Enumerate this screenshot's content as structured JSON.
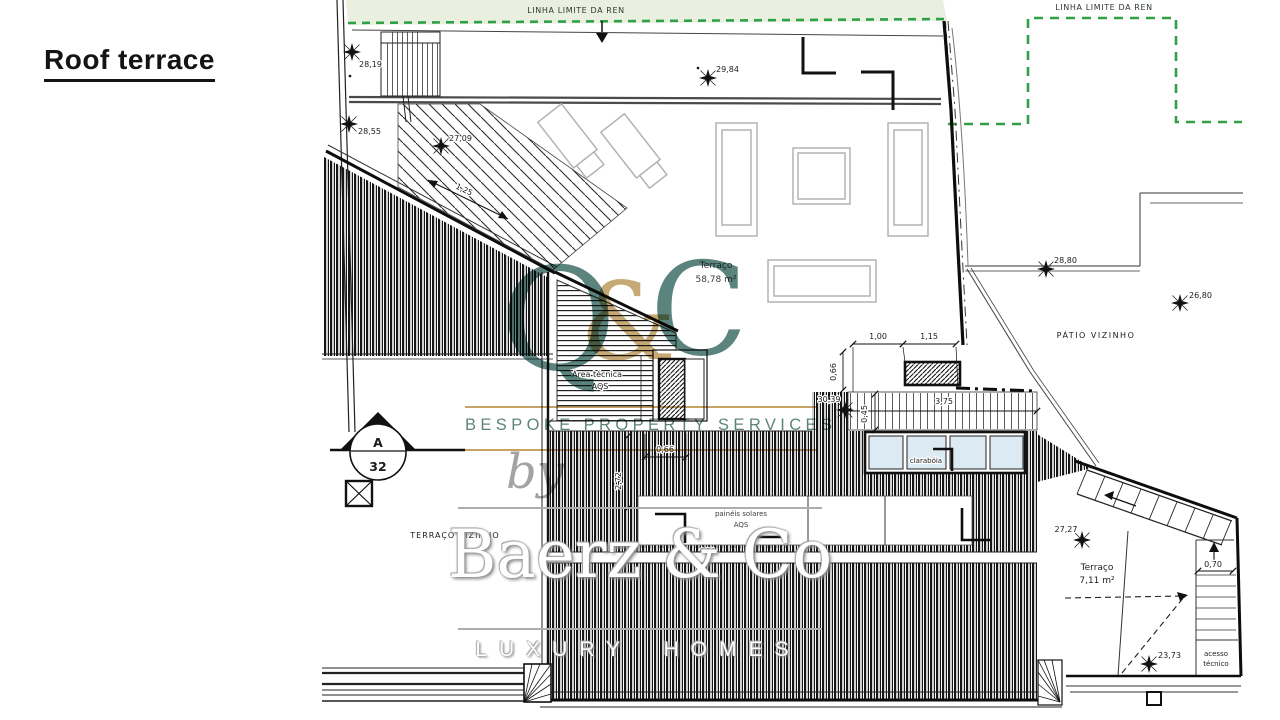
{
  "page": {
    "title": "Roof terrace"
  },
  "plan": {
    "ren_label": "LINHA LIMITE DA REN",
    "areas": {
      "main": {
        "name": "Terraço",
        "size": "58,78 m²"
      },
      "small": {
        "name": "Terraço",
        "size": "7,11 m²"
      },
      "tecnica": {
        "line1": "Área técnica",
        "line2": "AQS"
      },
      "paineis": {
        "line1": "painéis solares",
        "line2": "AQS"
      },
      "claraboia": "clarabóia",
      "patio": "PÁTIO VIZINHO",
      "terraco_vizinho": "TERRAÇO VIZINHO",
      "acesso": {
        "line1": "acesso",
        "line2": "técnico"
      }
    },
    "elevations": {
      "e2819": "28,19",
      "e2984": "29,84",
      "e2855": "28,55",
      "e2709": "27,09",
      "e2880": "28,80",
      "e2680": "26,80",
      "e3039": "30,39",
      "e2727": "27,27",
      "e2373": "23,73"
    },
    "dims": {
      "d125": "1,25",
      "d100": "1,00",
      "d115": "1,15",
      "d066a": "0,66",
      "d045": "0,45",
      "d375": "3,75",
      "d066b": "0,66",
      "d272": "2,72",
      "d424": "4,24",
      "d070": "0,70"
    },
    "section": {
      "letter": "A",
      "number": "32"
    }
  },
  "watermark": {
    "q": "Q",
    "amp": "&",
    "c": "C",
    "services": "BESPOKE PROPERTY SERVICES",
    "by": "by",
    "brand": "Baerz & Co",
    "tagline": "LUXURY HOMES"
  },
  "colors": {
    "teal": "#4E7A74",
    "gold": "#C19A57",
    "ren_green": "#2FA045",
    "ren_band_fill": "#E9F0E0",
    "skylight": "#DCEBF3",
    "furniture_gray": "#B3B3B3"
  }
}
